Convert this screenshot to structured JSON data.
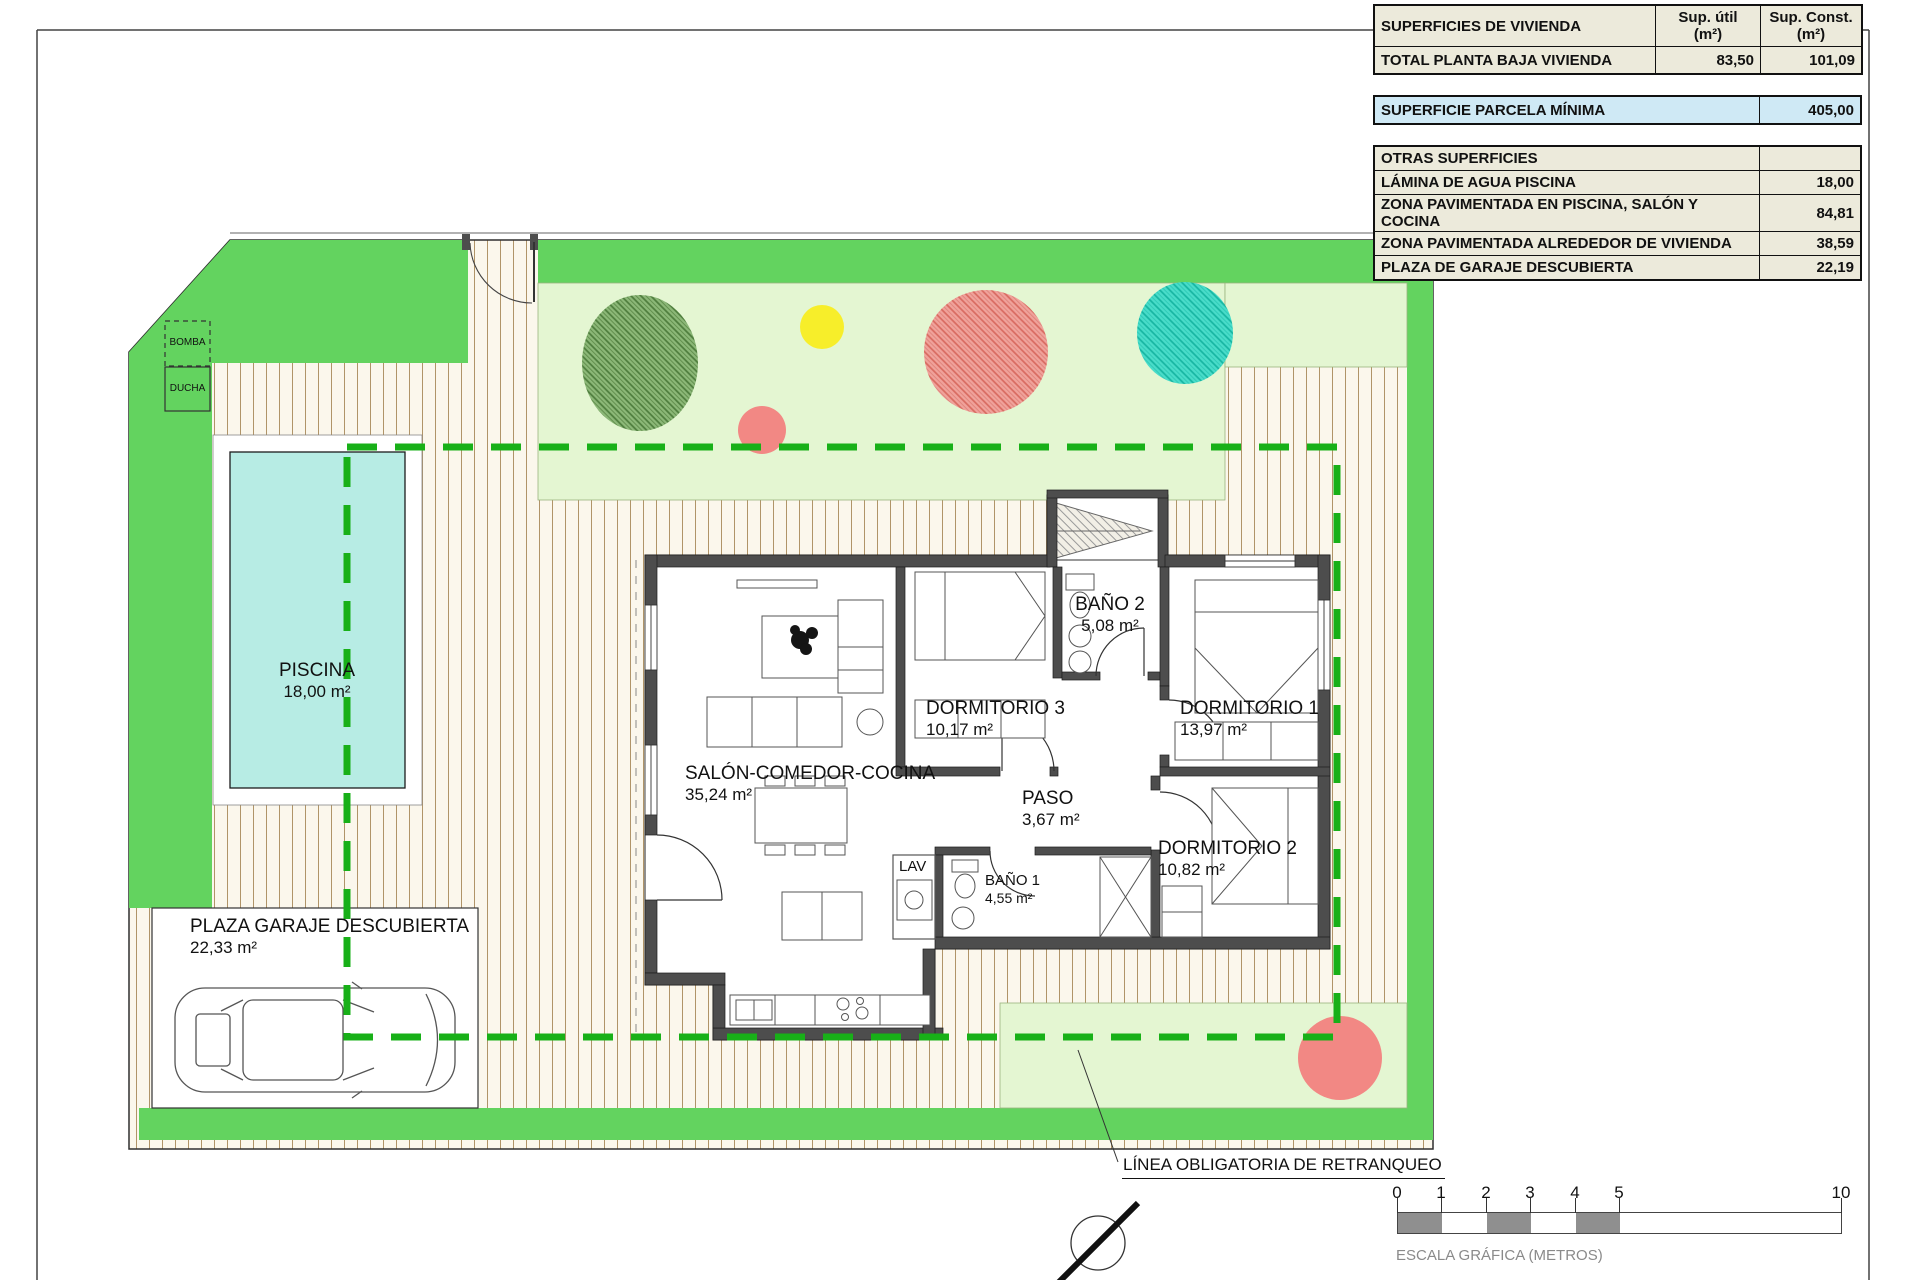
{
  "areas_table": {
    "title": "SUPERFICIES DE VIVIENDA",
    "col_util": "Sup. útil",
    "col_const": "Sup. Const.",
    "unit": "(m²)",
    "rows": [
      {
        "label": "TOTAL PLANTA BAJA VIVIENDA",
        "util": "83,50",
        "const": "101,09"
      }
    ],
    "parcela": {
      "label": "SUPERFICIE PARCELA MÍNIMA",
      "value": "405,00"
    },
    "otras": {
      "title": "OTRAS SUPERFICIES",
      "rows": [
        {
          "label": "LÁMINA DE AGUA PISCINA",
          "value": "18,00"
        },
        {
          "label": "ZONA PAVIMENTADA EN PISCINA, SALÓN Y COCINA",
          "value": "84,81"
        },
        {
          "label": "ZONA PAVIMENTADA ALREDEDOR DE VIVIENDA",
          "value": "38,59"
        },
        {
          "label": "PLAZA DE GARAJE DESCUBIERTA",
          "value": "22,19"
        }
      ]
    }
  },
  "rooms": [
    {
      "name": "SALÓN-COMEDOR-COCINA",
      "area": "35,24 m²"
    },
    {
      "name": "DORMITORIO 3",
      "area": "10,17 m²"
    },
    {
      "name": "BAÑO 2",
      "area": "5,08 m²"
    },
    {
      "name": "DORMITORIO 1",
      "area": "13,97 m²"
    },
    {
      "name": "PASO",
      "area": "3,67 m²"
    },
    {
      "name": "BAÑO 1",
      "area": "4,55 m²"
    },
    {
      "name": "DORMITORIO 2",
      "area": "10,82 m²"
    },
    {
      "name": "LAV",
      "area": ""
    }
  ],
  "site": {
    "piscina": {
      "name": "PISCINA",
      "area": "18,00 m²"
    },
    "garaje": {
      "name": "PLAZA GARAJE DESCUBIERTA",
      "area": "22,33 m²"
    },
    "bomba": "BOMBA",
    "ducha": "DUCHA",
    "retranqueo_label": "LÍNEA OBLIGATORIA DE RETRANQUEO"
  },
  "scalebar": {
    "ticks": [
      "0",
      "1",
      "2",
      "3",
      "4",
      "5",
      "10"
    ],
    "label": "ESCALA GRÁFICA (METROS)"
  },
  "colors": {
    "lawn_strip": "#63d35f",
    "garden_light": "#e4f6d2",
    "pool_water": "#b7ece4",
    "retranqueo_dash": "#18b018",
    "paving_line": "#b09468",
    "wall_gray": "#4d4d4d",
    "table_beige": "#eceadb",
    "table_blue": "#cfe9f5",
    "tree_green": "#6f9e53",
    "tree_red": "#ef8e87",
    "tree_teal": "#2fd2bf",
    "tree_yellow": "#f7ee2a",
    "scale_gray": "#8f8f8f"
  }
}
